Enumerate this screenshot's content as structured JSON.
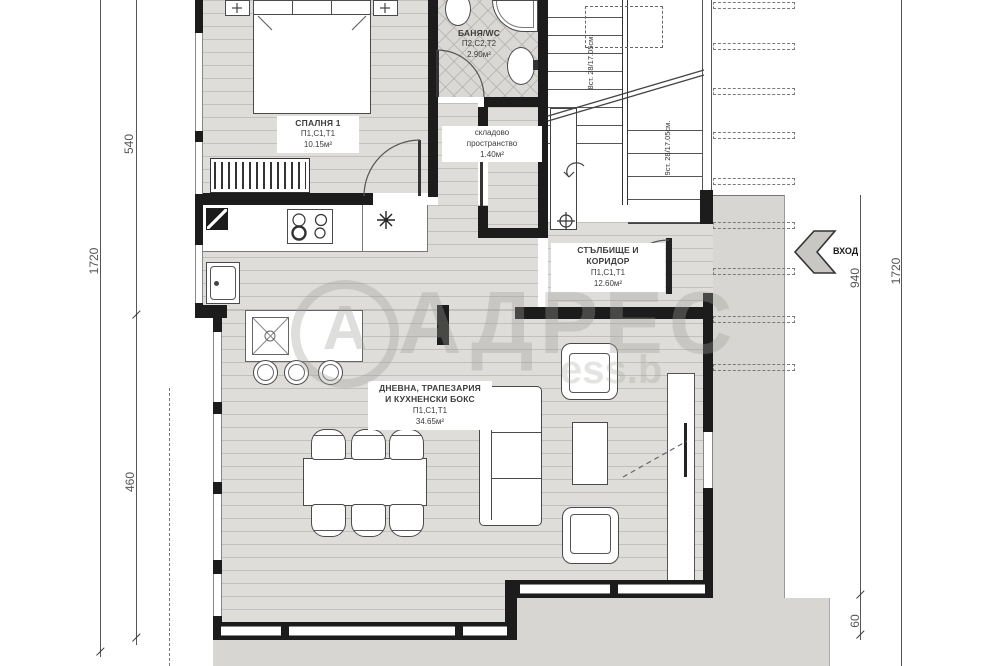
{
  "rooms": {
    "bedroom": {
      "name": "СПАЛНЯ 1",
      "layers": "П1,С1,Т1",
      "area": "10.15м²"
    },
    "bathroom": {
      "name": "БАНЯ/WC",
      "layers": "П2,С2,Т2",
      "area": "2.90м²"
    },
    "storage": {
      "name1": "складово",
      "name2": "пространство",
      "area": "1.40м²"
    },
    "corridor": {
      "name1": "СТЪЛБИЩЕ И",
      "name2": "КОРИДОР",
      "layers": "П1,С1,Т1",
      "area": "12.60м²"
    },
    "living": {
      "name1": "ДНЕВНА, ТРАПЕЗАРИЯ",
      "name2": "И КУХНЕНСКИ БОКС",
      "layers": "П1,С1,Т1",
      "area": "34.65м²"
    }
  },
  "stairs": {
    "flight_up": "8ст. 28/17.05см.",
    "flight_down": "9ст. 28/17.05см."
  },
  "entrance": {
    "label": "ВХОД"
  },
  "dimensions": {
    "left_outer": "1720",
    "left_top": "540",
    "left_bottom": "460",
    "right_inner": "940",
    "right_outer": "1720",
    "bottom_right": "60"
  },
  "watermark": {
    "logo_letter": "А",
    "brand": "АДРЕС",
    "partial_text": "ess.b"
  },
  "colors": {
    "wall": "#1c1c1c",
    "floor": "#deddd9",
    "tile": "#d9d8d4",
    "terrace": "#d7d6d2",
    "watermark": "#9e9e98",
    "dimension_text": "#555555",
    "label_text": "#3c3c3c"
  }
}
